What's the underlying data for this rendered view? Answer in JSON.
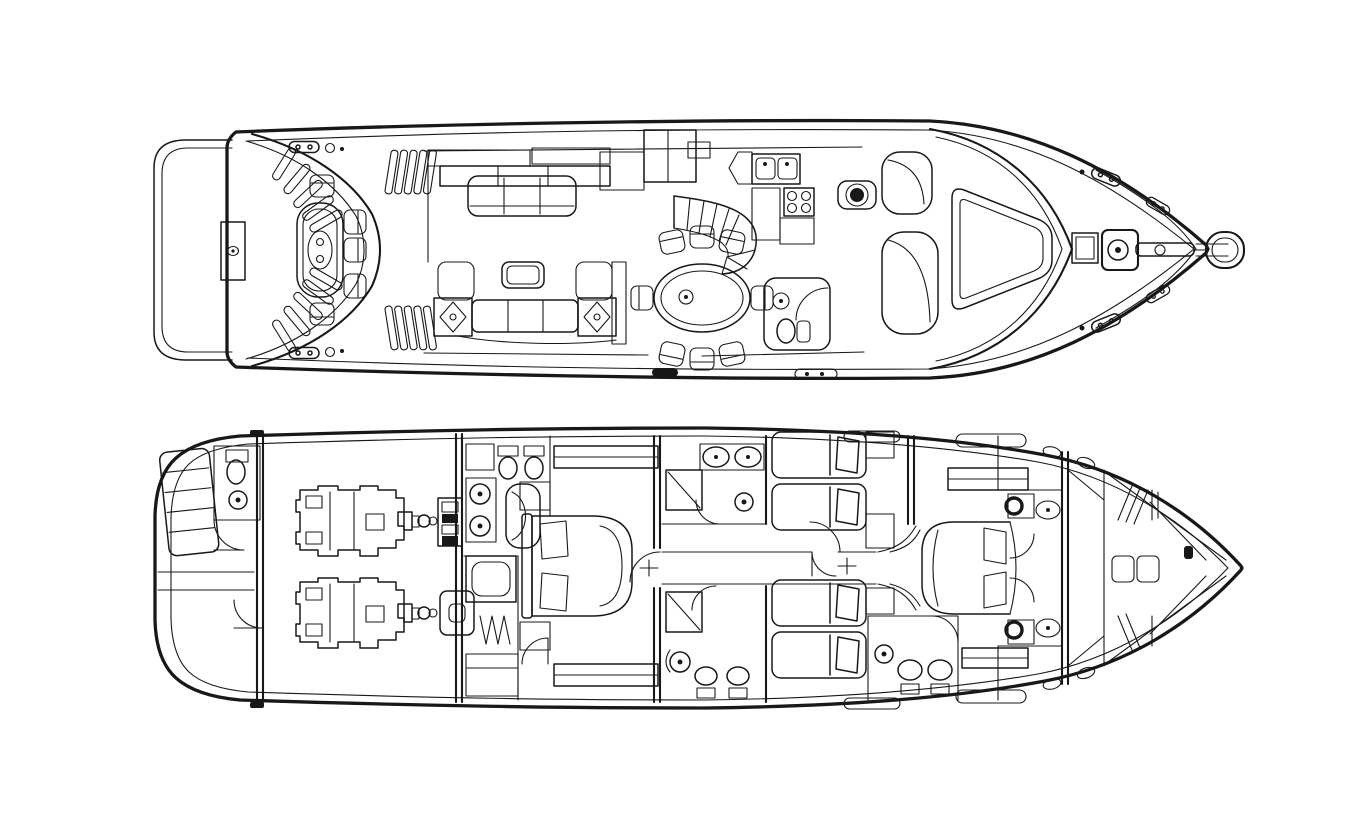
{
  "page": {
    "title": "Motor yacht general arrangement drawing - two deck plans, top view",
    "background": "#ffffff"
  },
  "drawing": {
    "ink": "#181818",
    "paper": "#ffffff",
    "style": "black and white technical line drawing",
    "decks": [
      {
        "id": "main-deck",
        "label": "Main deck and exterior plan (bow to the right)",
        "features": [
          "swim platform",
          "transom boarding stairs and gratings",
          "aft deck table with chairs",
          "transom locker",
          "mooring cleats",
          "salon sofa",
          "salon settee with speaker end tables",
          "coffee table",
          "sideboard cabinets",
          "curved staircase",
          "dining table for six",
          "galley with twin sinks and four-burner stove",
          "day head with toilet and basin",
          "helm seat",
          "curved companion settees",
          "raked windshield",
          "foredeck windscreen panel",
          "deck hatch",
          "anchor windlass with chain",
          "bow pulpit"
        ]
      },
      {
        "id": "lower-deck",
        "label": "Lower deck accommodation plan (bow to the right)",
        "features": [
          "transom crew area with head and stairs",
          "engine room with twin engines",
          "shaft couplings and gearboxes",
          "full-beam master cabin with double bed",
          "master bathroom with twin basins, toilet and bidet",
          "bathtub",
          "walk-in wardrobe with hanging lockers",
          "centre corridor",
          "guest twin cabins",
          "guest bathrooms with showers and toilets",
          "VIP cabin with island double bed",
          "VIP en-suite compartments",
          "forepeak stowage with hanging lockers"
        ]
      }
    ]
  }
}
